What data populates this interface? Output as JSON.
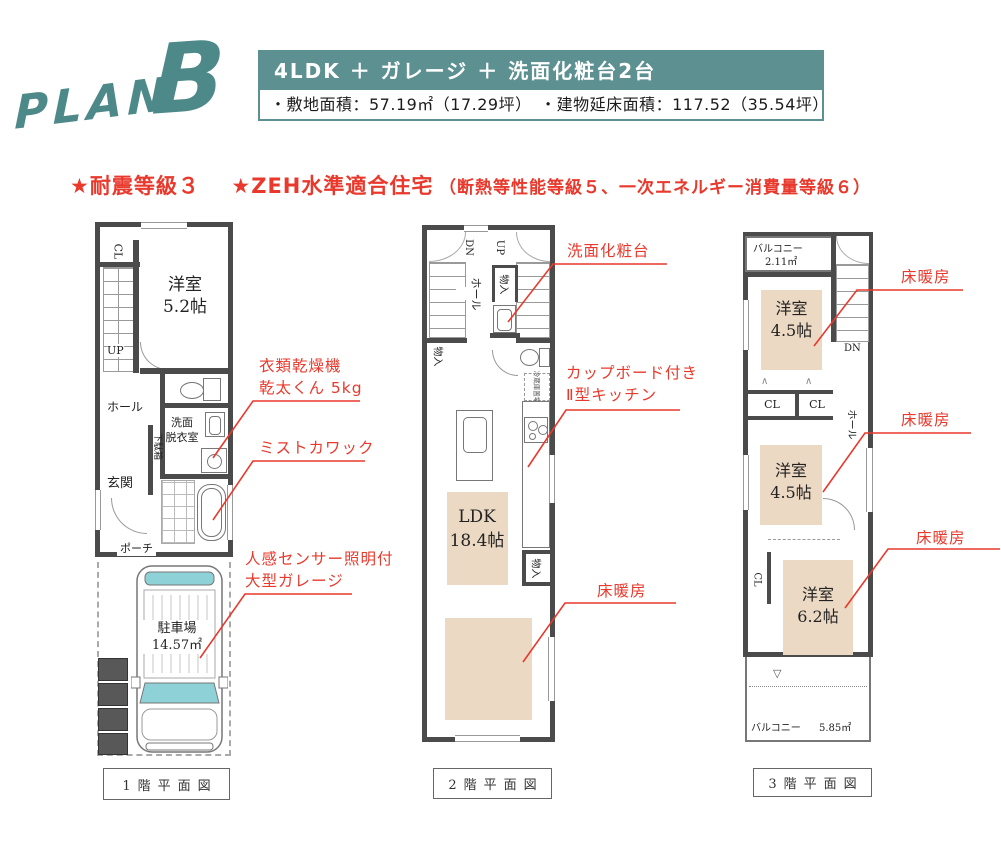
{
  "logo": {
    "plan_text": "PLAN",
    "letter": "B"
  },
  "header": {
    "title": "4LDK ＋ ガレージ ＋ 洗面化粧台2台",
    "areas": "・敷地面積：57.19㎡（17.29坪）　・建物延床面積：117.52（35.54坪）"
  },
  "features": {
    "quake": "★耐震等級３",
    "zeh": "★ZEH水準適合住宅",
    "zeh_note": "（断熱等性能等級５、一次エネルギー消費量等級６）"
  },
  "colors": {
    "teal": "#5d9191",
    "logo_teal": "#4d8989",
    "red": "#e8392c",
    "beige": "#ecd9c3",
    "wall": "#4b4b4b",
    "car_glass": "#8ed2d8"
  },
  "plan1": {
    "caption": "1階平面図",
    "labels": {
      "cl": "CL",
      "up": "UP",
      "room_name": "洋室",
      "room_size": "5.2帖",
      "hall": "ホール",
      "wash1": "洗面",
      "wash2": "脱衣室",
      "entrance": "玄関",
      "shoe_cabinet": "下駄箱",
      "porch": "ポーチ",
      "parking_name": "駐車場",
      "parking_size": "14.57㎡"
    },
    "ann": {
      "dryer1": "衣類乾燥機",
      "dryer2": "乾太くん 5kg",
      "mist": "ミストカワック",
      "garage1": "人感センサー照明付",
      "garage2": "大型ガレージ"
    }
  },
  "plan2": {
    "caption": "2階平面図",
    "labels": {
      "dn": "DN",
      "up": "UP",
      "hall": "ホール",
      "closet_top": "物入",
      "closet_left": "物入",
      "closet_bottom": "物入",
      "fridge": "冷蔵庫置場",
      "ldk_name": "LDK",
      "ldk_size": "18.4帖"
    },
    "ann": {
      "vanity": "洗面化粧台",
      "kitchen1": "カップボード付き",
      "kitchen2": "Ⅱ型キッチン",
      "heating": "床暖房"
    }
  },
  "plan3": {
    "caption": "3階平面図",
    "labels": {
      "balcony_top_name": "バルコニー",
      "balcony_top_size": "2.11㎡",
      "dn": "DN",
      "hall": "ホール",
      "cl1": "CL",
      "cl2": "CL",
      "cl3": "CL",
      "room1_name": "洋室",
      "room1_size": "4.5帖",
      "room2_name": "洋室",
      "room2_size": "4.5帖",
      "room3_name": "洋室",
      "room3_size": "6.2帖",
      "balcony_bottom_name": "バルコニー",
      "balcony_bottom_size": "5.85㎡",
      "marker": "▽"
    },
    "ann": {
      "heating1": "床暖房",
      "heating2": "床暖房",
      "heating3": "床暖房"
    }
  }
}
